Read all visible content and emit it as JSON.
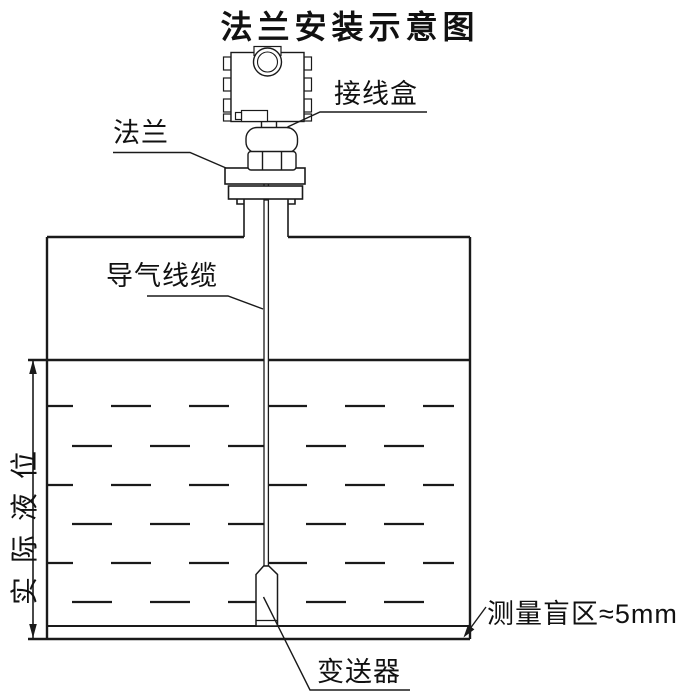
{
  "title": "法兰安装示意图",
  "labels": {
    "junction_box": "接线盒",
    "flange": "法兰",
    "air_cable": "导气线缆",
    "actual_level": "实际液位",
    "blind_zone": "测量盲区≈5mm",
    "transmitter": "变送器"
  },
  "colors": {
    "line": "#1a1a1a",
    "background": "#ffffff"
  }
}
